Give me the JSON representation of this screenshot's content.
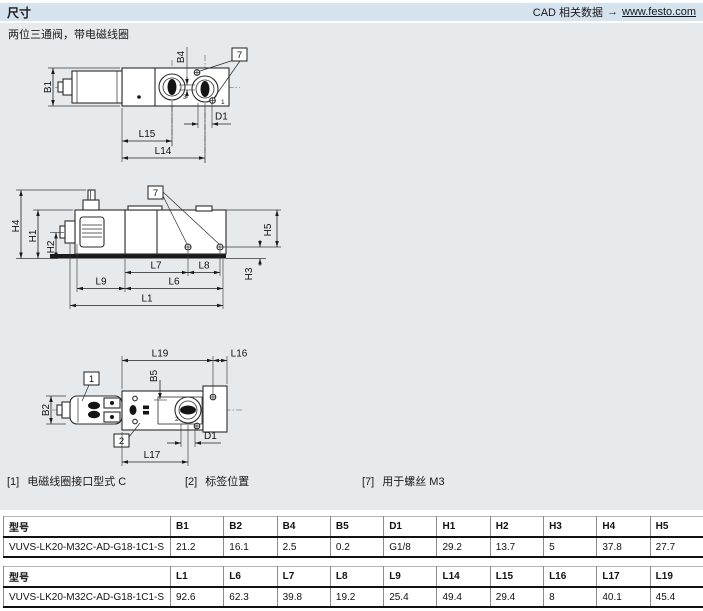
{
  "header": {
    "title": "尺寸",
    "cad_label": "CAD 相关数据",
    "cad_arrow": "→",
    "cad_link": "www.festo.com"
  },
  "subtitle": "两位三通阀，带电磁线圈",
  "dims": {
    "b1": "B1",
    "b2": "B2",
    "b4": "B4",
    "b5": "B5",
    "d1": "D1",
    "h1": "H1",
    "h2": "H2",
    "h3": "H3",
    "h4": "H4",
    "h5": "H5",
    "l1": "L1",
    "l6": "L6",
    "l7": "L7",
    "l8": "L8",
    "l9": "L9",
    "l14": "L14",
    "l15": "L15",
    "l16": "L16",
    "l17": "L17",
    "l19": "L19"
  },
  "callouts": {
    "c1": "1",
    "c2": "2",
    "c7": "7"
  },
  "ports": {
    "p1": "1",
    "p2": "2",
    "p3": "3"
  },
  "footnotes": [
    {
      "ref": "[1]",
      "text": "电磁线圈接口型式 C"
    },
    {
      "ref": "[2]",
      "text": "标签位置"
    },
    {
      "ref": "[7]",
      "text": "用于螺丝 M3"
    }
  ],
  "tables": [
    {
      "headers": [
        "型号",
        "B1",
        "B2",
        "B4",
        "B5",
        "D1",
        "H1",
        "H2",
        "H3",
        "H4",
        "H5"
      ],
      "rows": [
        [
          "VUVS-LK20-M32C-AD-G18-1C1-S",
          "21.2",
          "16.1",
          "2.5",
          "0.2",
          "G1/8",
          "29.2",
          "13.7",
          "5",
          "37.8",
          "27.7"
        ]
      ]
    },
    {
      "headers": [
        "型号",
        "L1",
        "L6",
        "L7",
        "L8",
        "L9",
        "L14",
        "L15",
        "L16",
        "L17",
        "L19"
      ],
      "rows": [
        [
          "VUVS-LK20-M32C-AD-G18-1C1-S",
          "92.6",
          "62.3",
          "39.8",
          "19.2",
          "25.4",
          "49.4",
          "29.4",
          "8",
          "40.1",
          "45.4"
        ]
      ]
    }
  ],
  "colors": {
    "header_bg": "#d5e3ef",
    "panel_bg": "#e7eaec",
    "line_dark": "#1a1a1a"
  }
}
